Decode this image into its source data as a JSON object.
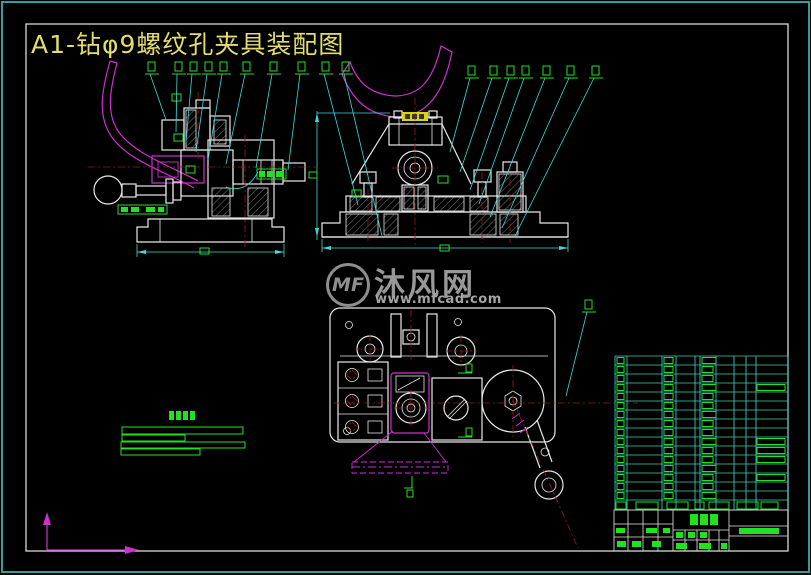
{
  "sheet": {
    "title": "A1-钻φ9螺纹孔夹具装配图"
  },
  "watermark": {
    "logo_text": "MF",
    "site_name": "沐风网",
    "site_url": "www.mfcad.com"
  },
  "palette": {
    "background": "#000000",
    "outer_border_teal": "#2f9e9e",
    "sheet_frame_white": "#e8e8e8",
    "outline_white": "#e8e8e8",
    "dimension_cyan": "#3fd9d9",
    "label_green": "#22e022",
    "centerline_red": "#a01818",
    "phantom_magenta": "#cf2fcf",
    "title_yellow": "#e3dd6d",
    "highlight_yellow": "#d6d600",
    "watermark_gray": "#979797",
    "table_line_green": "#3cd0a8"
  },
  "bom_table": {
    "body_rows": 16,
    "header_rows": 1
  },
  "tech_notes": {
    "line_count": 4
  },
  "balloons": {
    "group1_count": 10,
    "group2_count": 7,
    "extra_count": 1
  }
}
